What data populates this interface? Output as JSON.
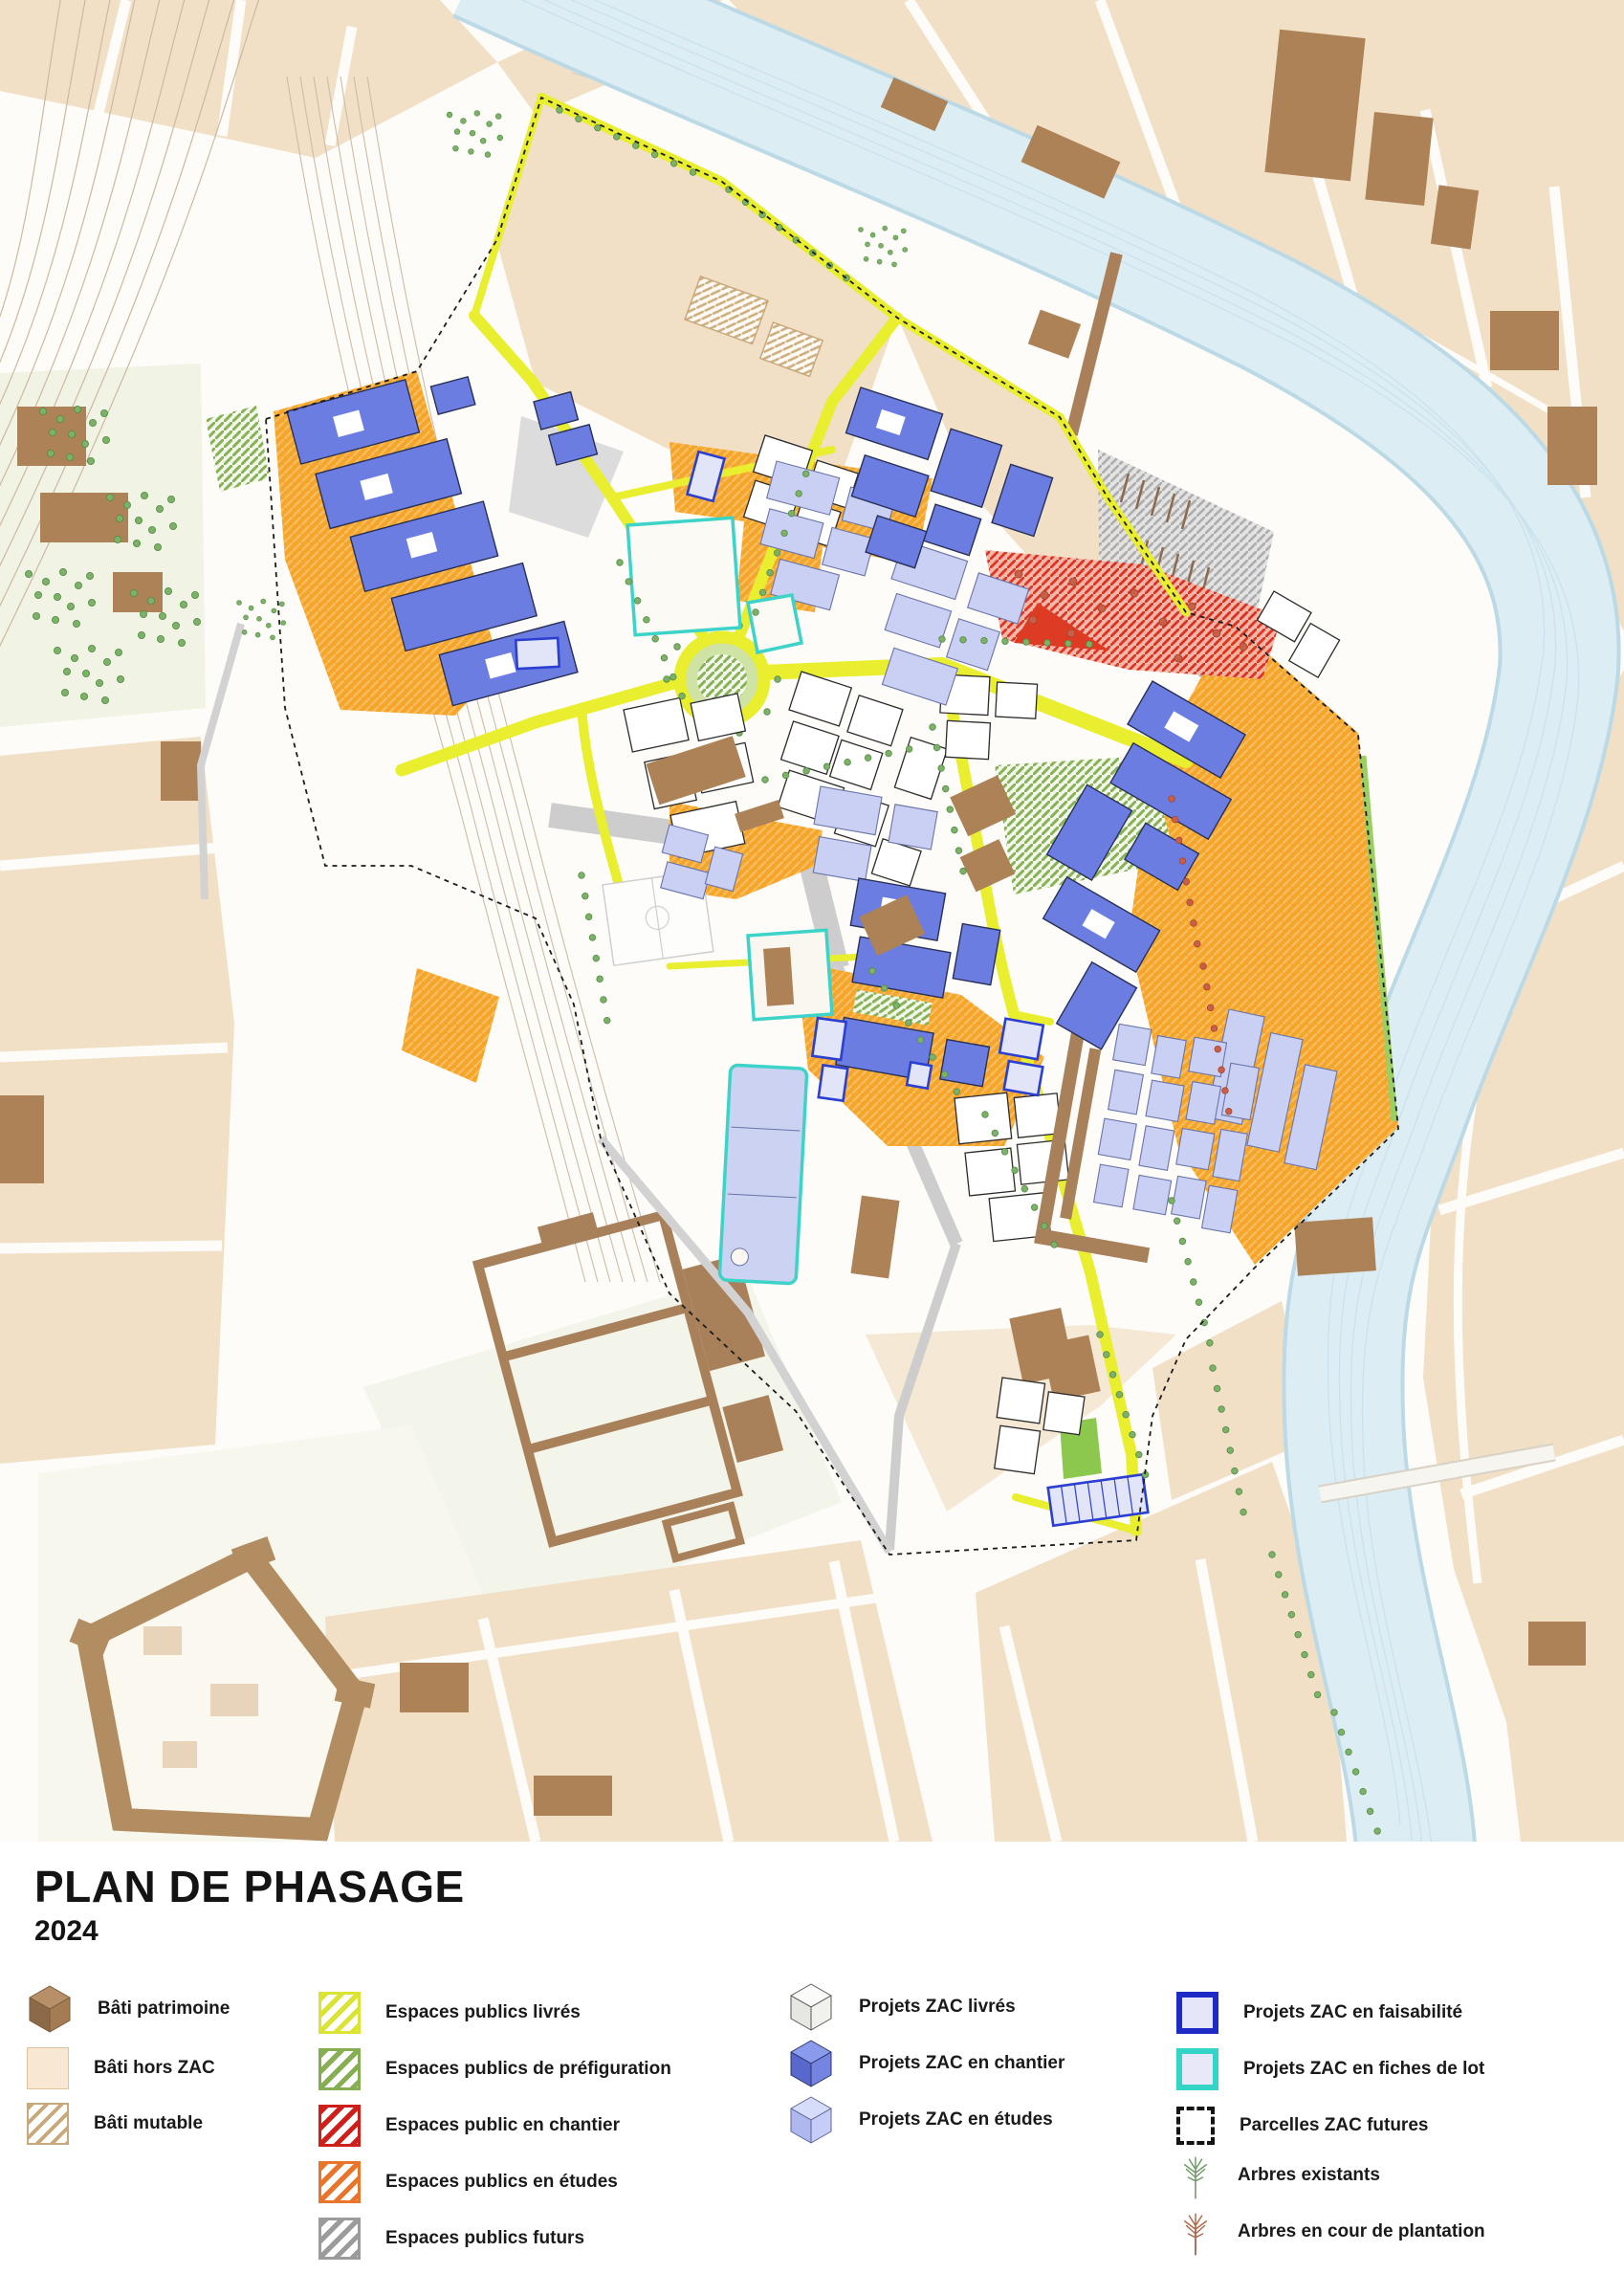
{
  "title": {
    "main": "PLAN DE PHASAGE",
    "year": "2024"
  },
  "legend": {
    "bati": [
      {
        "label": "Bâti patrimoine",
        "swatch": "cube-brown",
        "color": "#a9805a"
      },
      {
        "label": "Bâti hors ZAC",
        "swatch": "square-solid",
        "color": "#f8e8d3"
      },
      {
        "label": "Bâti mutable",
        "swatch": "square-hatch",
        "color": "#c9a87c"
      }
    ],
    "espaces": [
      {
        "label": "Espaces publics livrés",
        "swatch": "square-hatch",
        "color": "#dbe434"
      },
      {
        "label": "Espaces publics de préfiguration",
        "swatch": "square-hatch",
        "color": "#86ae53"
      },
      {
        "label": "Espaces public en chantier",
        "swatch": "square-hatch",
        "color": "#cf1f1a"
      },
      {
        "label": "Espaces publics en études",
        "swatch": "square-hatch",
        "color": "#e8752b"
      },
      {
        "label": "Espaces publics futurs",
        "swatch": "square-hatch",
        "color": "#9b9b9b"
      }
    ],
    "projets": [
      {
        "label": "Projets ZAC livrés",
        "swatch": "cube-white",
        "color": "#f2f2ee"
      },
      {
        "label": "Projets ZAC en chantier",
        "swatch": "cube-blue",
        "color": "#6b7de0"
      },
      {
        "label": "Projets ZAC en études",
        "swatch": "cube-periwinkle",
        "color": "#c9d0f3"
      }
    ],
    "parcelles": [
      {
        "label": "Projets ZAC en faisabilité",
        "swatch": "square-outline",
        "color": "#1d2bc4"
      },
      {
        "label": "Projets ZAC en fiches de lot",
        "swatch": "square-outline",
        "color": "#35d4c8"
      },
      {
        "label": "Parcelles ZAC futures",
        "swatch": "square-dashed",
        "color": "#141414"
      },
      {
        "label": "Arbres existants",
        "swatch": "tree",
        "color": "#6f9e68"
      },
      {
        "label": "Arbres en cour de plantation",
        "swatch": "tree",
        "color": "#b06b4c"
      }
    ]
  },
  "map_colors": {
    "river": "#dcedf3",
    "espaces_livres_voirie": "#e9ee2f",
    "espaces_en_etudes": "#f5a52a",
    "espaces_en_chantier": "#dd3b24",
    "espaces_prefiguration": "#87b356",
    "espaces_futurs": "#a9a9a9",
    "projets_en_chantier": "#6b7de0",
    "projets_en_etudes": "#c9d0f3",
    "bati_patrimoine": "#a9805a",
    "bati_hors_zac": "#f1dfc6"
  }
}
